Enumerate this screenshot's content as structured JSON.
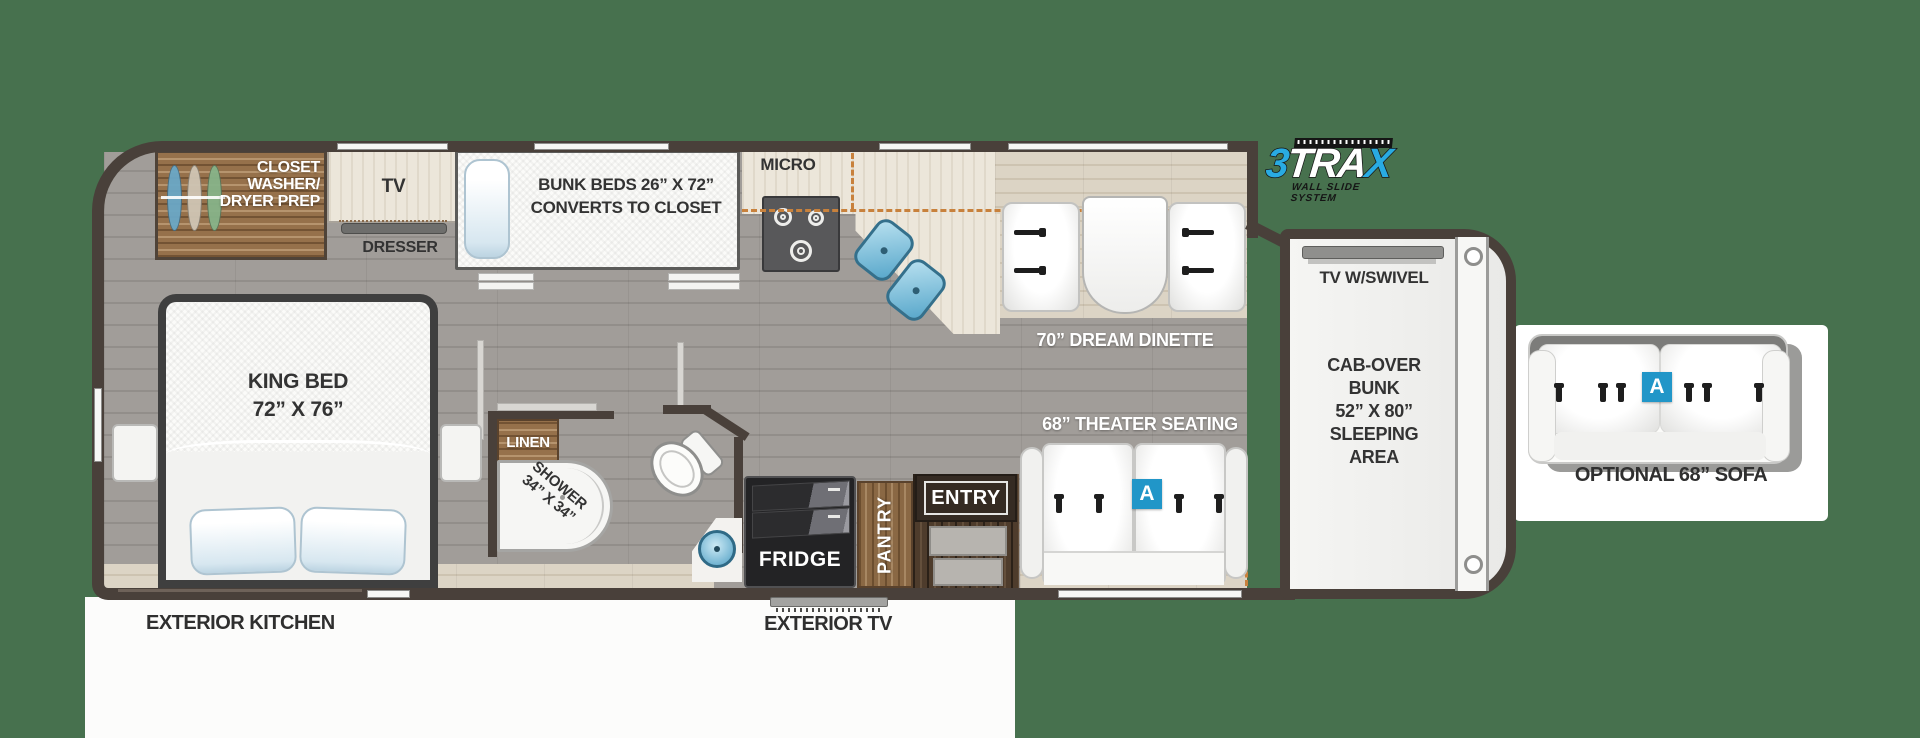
{
  "colors": {
    "background": "#47714E",
    "wall": "#49403A",
    "accent_blue": "#2196C8",
    "slide_dash": "#C8813C",
    "logo_blue": "#29ABE2"
  },
  "rooms": {
    "closet": {
      "line1": "CLOSET",
      "line2": "WASHER/",
      "line3": "DRYER PREP"
    },
    "tv_cabinet": "TV",
    "dresser": "DRESSER",
    "bunk_beds": {
      "line1": "BUNK BEDS 26” X 72”",
      "line2": "CONVERTS TO CLOSET"
    },
    "micro": "MICRO",
    "dinette": "70” DREAM DINETTE",
    "kitchen": {
      "fridge": "FRIDGE",
      "pantry": "PANTRY"
    },
    "bath": {
      "linen": "LINEN",
      "shower_line1": "SHOWER",
      "shower_line2": "34” X 34”"
    },
    "bedroom": {
      "line1": "KING BED",
      "line2": "72” X 76”"
    },
    "living": {
      "theater": "68” THEATER SEATING",
      "entry": "ENTRY",
      "badge": "A"
    },
    "cab": {
      "tv": "TV W/SWIVEL",
      "line1": "CAB-OVER",
      "line2": "BUNK",
      "line3": "52” X 80”",
      "line4": "SLEEPING",
      "line5": "AREA"
    }
  },
  "exterior": {
    "kitchen": "EXTERIOR KITCHEN",
    "tv": "EXTERIOR TV"
  },
  "sofa": {
    "label": "OPTIONAL 68” SOFA",
    "badge": "A"
  },
  "logo": {
    "three": "3",
    "tra": "TRA",
    "x": "X",
    "subtitle": "WALL SLIDE SYSTEM"
  }
}
